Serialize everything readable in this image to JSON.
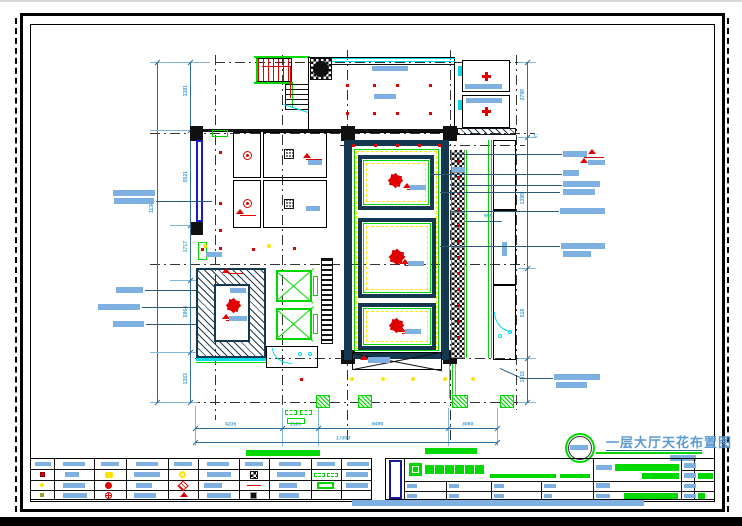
{
  "title": {
    "text": "一层大厅天花布置图"
  },
  "dims": {
    "left_chain": [
      "3381",
      "5521",
      "1717",
      "5864",
      "1353"
    ],
    "left_total": "11388",
    "right_chain": [
      "2788",
      "1398",
      "518",
      "1315"
    ],
    "mid": [
      "1500",
      "955"
    ],
    "bottom_chain": [
      "4235",
      "1565",
      "8490",
      "3060"
    ],
    "bottom_total": "17300",
    "grid_label": "C"
  },
  "colors": {
    "heavy_wall": "#14384f",
    "accent_green": "#00d800",
    "symbol_red": "#e00000",
    "window_cyan": "#00dcec",
    "light_yellow": "#ffe400",
    "text_block_blue": "#7fb0e2",
    "dimension_text": "#45a0d8",
    "title_text": "#5b9bd5"
  },
  "icons": {
    "chandelier": "eight-point-star",
    "sprinkler": "red-dot",
    "downlight": "yellow-dot",
    "elevator": "crossed-box",
    "column": "black-square",
    "legend_symbols": [
      "red-box",
      "yellow-double-dot",
      "yellow-ring",
      "checker-box",
      "green-dashed-pair",
      "yellow-dot",
      "red-dot-arrow",
      "red-diamond",
      "red-line",
      "green-rect-outline",
      "olive-dot",
      "red-circle-cross",
      "red-flag",
      "black-square"
    ]
  }
}
